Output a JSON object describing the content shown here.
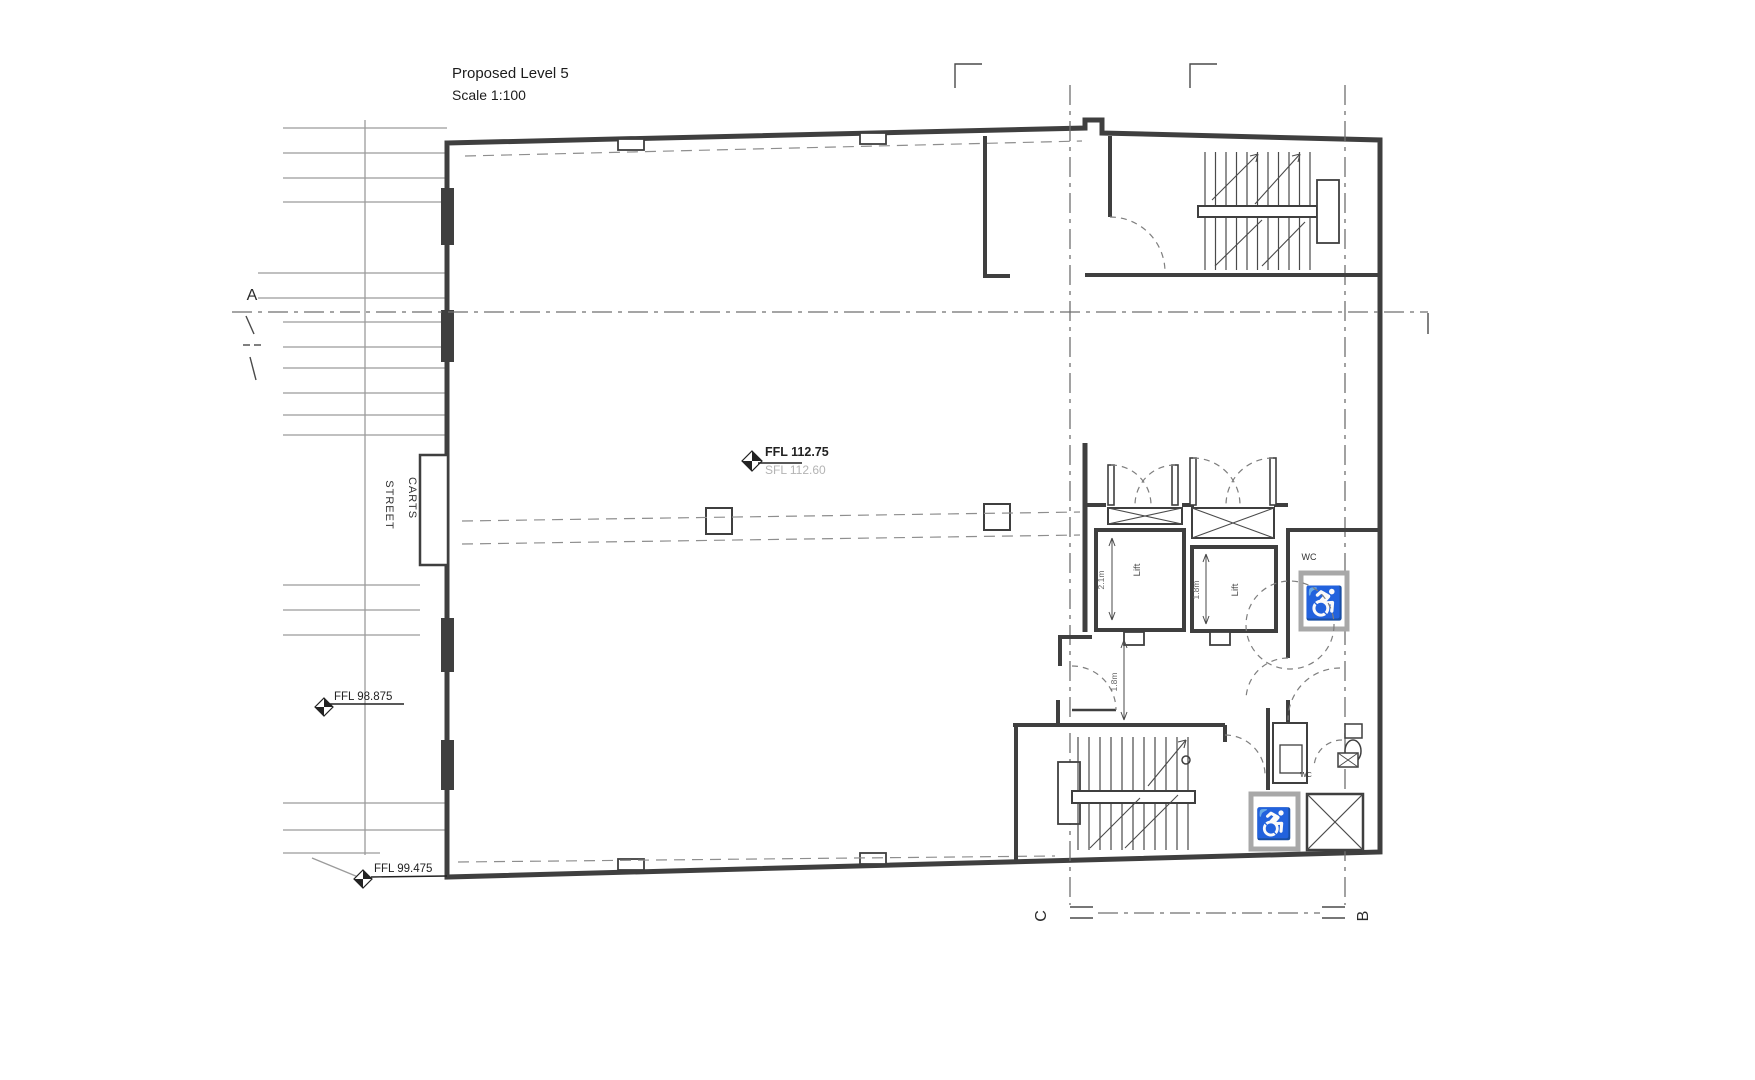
{
  "title": {
    "line1": "Proposed Level 5",
    "line2": "Scale 1:100"
  },
  "street": {
    "line1": "CARTS",
    "line2": "STREET"
  },
  "grid": {
    "a": "A",
    "b": "B",
    "c": "C"
  },
  "levels": {
    "main_ffl": "FFL 112.75",
    "main_sfl": "SFL 112.60",
    "street_upper": "FFL 98.875",
    "street_lower": "FFL 99.475"
  },
  "rooms": {
    "lift1_label": "Lift",
    "lift1_dim": "2.1m",
    "lift2_label": "Lift",
    "lift2_dim": "1.8m",
    "corridor_dim": "1.8m",
    "wc_upper": "WC",
    "wc_lower": "WC"
  },
  "icons": {
    "wheelchair": "♿"
  },
  "colors": {
    "wall": "#3f3f3f",
    "street_line": "#9b9b9b",
    "dashed_line": "#8e8e8e",
    "grid_line": "#6f6f6f",
    "text_dark": "#1c1c1c",
    "text_gray": "#b4b4b4",
    "accessible_box_border": "#a8a8a8"
  }
}
